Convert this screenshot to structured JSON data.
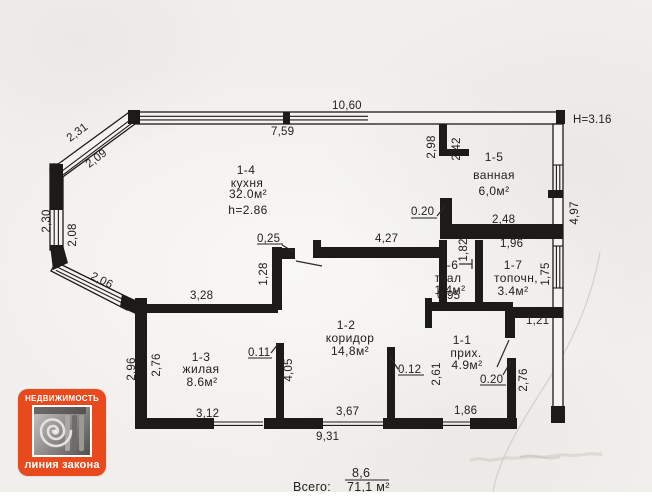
{
  "page": {
    "background": "#f1efec"
  },
  "plan": {
    "height_note": "Н=3.16",
    "rooms": [
      {
        "id": "1-4",
        "name": "кухня",
        "area": "32.0м²",
        "note": "h=2.86"
      },
      {
        "id": "1-5",
        "name": "ванная",
        "area": "6,0м²"
      },
      {
        "id": "1-6",
        "name": "туал",
        "area": "1.4м²"
      },
      {
        "id": "1-7",
        "name": "топочн,",
        "area": "3.4м²"
      },
      {
        "id": "1-2",
        "name": "коридор",
        "area": "14,8м²"
      },
      {
        "id": "1-3",
        "name": "жилая",
        "area": "8.6м²"
      },
      {
        "id": "1-1",
        "name": "прих.",
        "area": "4.9м²"
      }
    ],
    "dims": [
      {
        "t": "10,60"
      },
      {
        "t": "7,59"
      },
      {
        "t": "2,31"
      },
      {
        "t": "2,09"
      },
      {
        "t": "2,30"
      },
      {
        "t": "2,08"
      },
      {
        "t": "2,06"
      },
      {
        "t": "2,96"
      },
      {
        "t": "2,76"
      },
      {
        "t": "2,98"
      },
      {
        "t": "2,42"
      },
      {
        "t": "0.20"
      },
      {
        "t": "2,48"
      },
      {
        "t": "4,97"
      },
      {
        "t": "0,25"
      },
      {
        "t": "4,27"
      },
      {
        "t": "1,96"
      },
      {
        "t": "1,82"
      },
      {
        "t": "1,75"
      },
      {
        "t": "1,28"
      },
      {
        "t": "3,28"
      },
      {
        "t": "0,95"
      },
      {
        "t": "1,21"
      },
      {
        "t": "0.11"
      },
      {
        "t": "4,05"
      },
      {
        "t": "0.12"
      },
      {
        "t": "2,61"
      },
      {
        "t": "0.20"
      },
      {
        "t": "2,76"
      },
      {
        "t": "3,12"
      },
      {
        "t": "3,67"
      },
      {
        "t": "1,86"
      },
      {
        "t": "9,31"
      }
    ],
    "total": {
      "label": "Всего:",
      "numerator": "8,6",
      "denominator": "71,1 м²"
    }
  },
  "logo": {
    "line1": "НЕДВИЖИМОСТЬ",
    "line2": "линия закона",
    "accent": "#e8491d"
  }
}
